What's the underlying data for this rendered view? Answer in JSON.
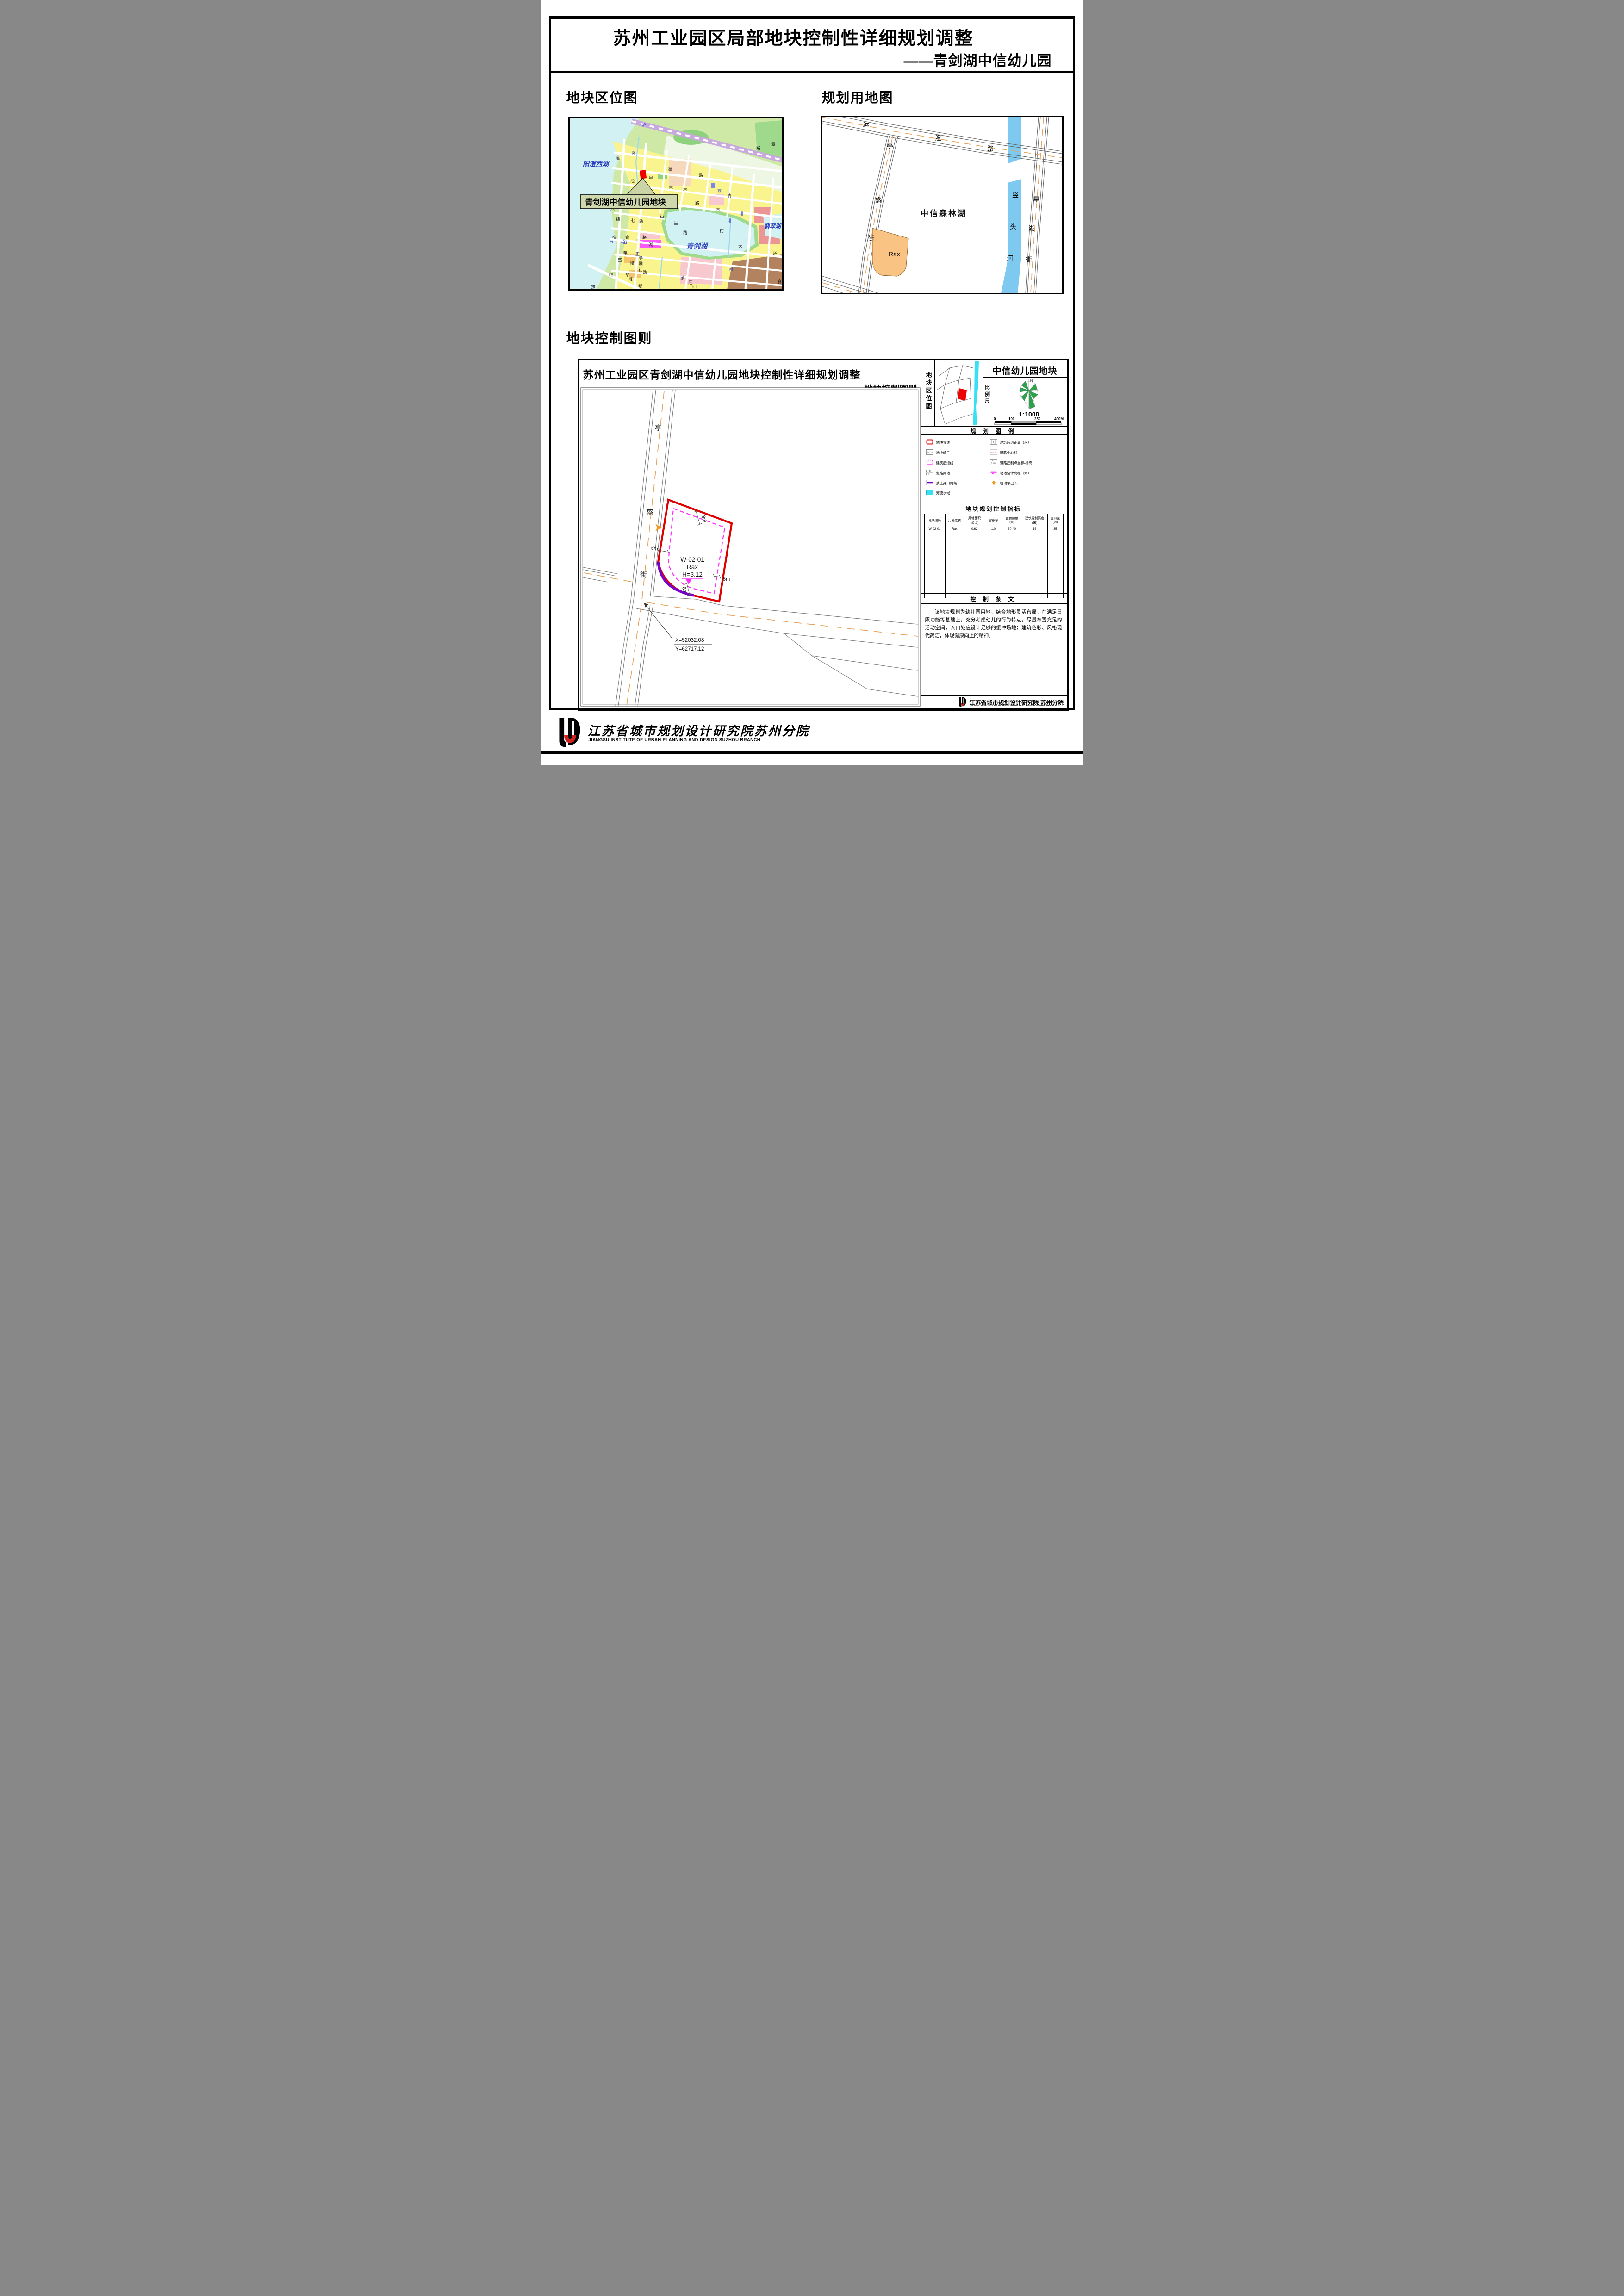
{
  "page": {
    "title_line1": "苏州工业园区局部地块控制性详细规划调整",
    "title_line2": "——青剑湖中信幼儿园"
  },
  "sections": {
    "location": "地块区位图",
    "landuse": "规划用地图",
    "control": "地块控制图则"
  },
  "location_map": {
    "lakes": {
      "yangchengxi": "阳澄西湖",
      "qingjian": "青剑湖",
      "feicui": "翡翠湖"
    },
    "callout": "青剑湖中信幼儿园地块",
    "lm": [
      "沪",
      "潭",
      "路",
      "竖",
      "运",
      "澄",
      "路",
      "头",
      "星",
      "亭",
      "亭",
      "西",
      "谊",
      "观",
      "路",
      "青",
      "青",
      "八",
      "亭",
      "纬",
      "七",
      "路",
      "街",
      "街",
      "港",
      "唯",
      "青",
      "路",
      "南",
      "泗",
      "河",
      "湖",
      "路",
      "街",
      "正",
      "亭",
      "雅",
      "街",
      "路",
      "唯",
      "盛",
      "隆",
      "唯",
      "华",
      "街",
      "墅",
      "独",
      "湖",
      "经",
      "四",
      "大",
      "道",
      "港",
      "河",
      "浪",
      "经",
      "唯"
    ]
  },
  "landuse_map": {
    "pm": [
      "运",
      "澄",
      "路",
      "亭",
      "盛",
      "街",
      "竖",
      "头",
      "河",
      "星",
      "湖",
      "街"
    ],
    "area_label": "中信森林湖",
    "plot_label": "Rax"
  },
  "control_chart": {
    "title": "苏州工业园区青剑湖中信幼儿园地块控制性详细规划调整",
    "subtitle": "地块控制图则",
    "road": [
      "亭",
      "盛",
      "街"
    ],
    "plot": {
      "code": "W-02-01",
      "use": "Rax",
      "elevation": "H=3.12"
    },
    "dims": {
      "top": "8m",
      "left": "5m",
      "right": "5m",
      "bottom": "8m"
    },
    "coords": {
      "x": "X=52032.08",
      "y": "Y=62717.12"
    }
  },
  "panel": {
    "location_label": "地块区位图",
    "plot_title": "中信幼儿园地块",
    "scale_label": "比例尺",
    "north": "N",
    "scale_ratio": "1:1000",
    "scale_ticks": [
      "0",
      "100",
      "250",
      "400M"
    ],
    "legend": {
      "title": "规 划 图 例",
      "left": [
        {
          "label": "地块界线",
          "icon": "plot-boundary"
        },
        {
          "label": "地块编号",
          "icon": "plot-number",
          "icon_text": "A-01-01"
        },
        {
          "label": "建筑后退线",
          "icon": "setback-line"
        },
        {
          "label": "道路用地",
          "icon": "road-land"
        },
        {
          "label": "禁止开口路段",
          "icon": "no-opening"
        },
        {
          "label": "河流水域",
          "icon": "river"
        }
      ],
      "right": [
        {
          "label": "建筑后退距离（米）",
          "icon": "setback-distance",
          "icon_text": "5"
        },
        {
          "label": "道路中心线",
          "icon": "road-centerline"
        },
        {
          "label": "道路控制点坐标/标高",
          "icon": "control-point"
        },
        {
          "label": "场地设计高程（米）",
          "icon": "site-elevation",
          "icon_text": "H=3.0"
        },
        {
          "label": "机动车出入口",
          "icon": "vehicle-entrance"
        }
      ]
    },
    "indicators": {
      "title": "地块规划控制指标",
      "headers": [
        {
          "a": "地块编码",
          "b": ""
        },
        {
          "a": "用地性质",
          "b": ""
        },
        {
          "a": "用地面积",
          "b": "(公顷)"
        },
        {
          "a": "容积率",
          "b": ""
        },
        {
          "a": "建筑密度",
          "b": "(%)"
        },
        {
          "a": "建筑控制高度",
          "b": "(米)"
        },
        {
          "a": "绿地率",
          "b": "(%)"
        }
      ],
      "row": [
        "W-02-01",
        "Rax",
        "0.62",
        "1.0",
        "30-40",
        "16",
        "35"
      ]
    },
    "provisions": {
      "title": "控 制 条 文",
      "text": "该地块规划为幼儿园用地，结合地形灵活布局，在满足日照功能等基础上，充分考虑幼儿的行为特点，尽量布置充足的活动空间，入口处应设计足够的缓冲场地；建筑色彩、风格现代简洁，体现健康向上的精神。"
    },
    "publisher": {
      "cn": "江苏省城市规划设计研究院 苏州分院",
      "en": "JIANGSU INSTITUTE OF URBAN PLANNING AND DESIGN SUZHOU BRANCH"
    }
  },
  "footer": {
    "cn": "江苏省城市规划设计研究院苏州分院",
    "en": "JIANGSU INSTITUTE OF URBAN PLANNING AND DESIGN SUZHOU BRANCH"
  },
  "colors": {
    "plot_boundary_red": "#dd0000",
    "setback_magenta": "#ff30ff",
    "no_opening_purple": "#7a00cc",
    "river_cyan": "#37e0f5",
    "river_blue": "#7ec9f0",
    "entrance_orange": "#f29a1f",
    "rax_fill": "#f8c383",
    "road_centerline": "#e8a35c",
    "compass_green": "#2fa14e",
    "railway_purple": "#c9a8de",
    "block_yellow": "#faf48f",
    "lake_fill": "#d2f1f3"
  }
}
